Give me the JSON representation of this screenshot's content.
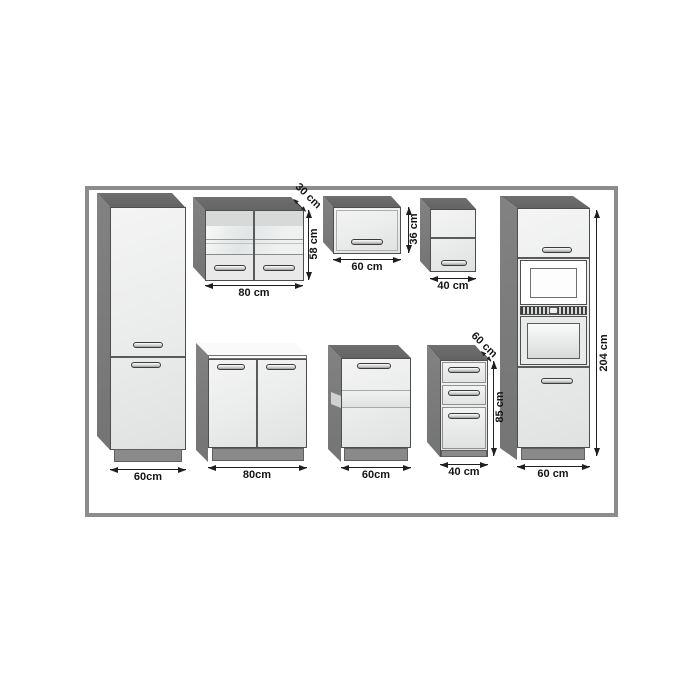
{
  "diagram": {
    "type": "kitchen-cabinet-dimension-diagram",
    "frame": {
      "border_color": "#8c8c8c",
      "background": "#ffffff"
    },
    "colors": {
      "carcass_side": "#7d7d7d",
      "carcass_top": "#6a6a6a",
      "front_face": "#ececec",
      "plinth": "#8a8a8a",
      "dimension_line": "#1f1f1f",
      "dimension_text": "#161616"
    },
    "cabinets": [
      {
        "name": "tall-larder-cabinet",
        "width_label": "60cm"
      },
      {
        "name": "wall-cabinet-double-glass",
        "width_label": "80 cm",
        "height_label": "58 cm",
        "depth_label": "30 cm"
      },
      {
        "name": "wall-cabinet-flap",
        "width_label": "60 cm",
        "height_label": "36 cm"
      },
      {
        "name": "wall-cabinet-narrow",
        "width_label": "40 cm"
      },
      {
        "name": "tall-oven-housing",
        "width_label": "60 cm",
        "height_label": "204 cm"
      },
      {
        "name": "base-cabinet-double-door",
        "width_label": "80cm"
      },
      {
        "name": "base-cabinet-single-door",
        "width_label": "60cm"
      },
      {
        "name": "base-drawer-unit",
        "width_label": "40 cm",
        "height_label": "85 cm",
        "depth_label": "60 cm"
      }
    ]
  }
}
